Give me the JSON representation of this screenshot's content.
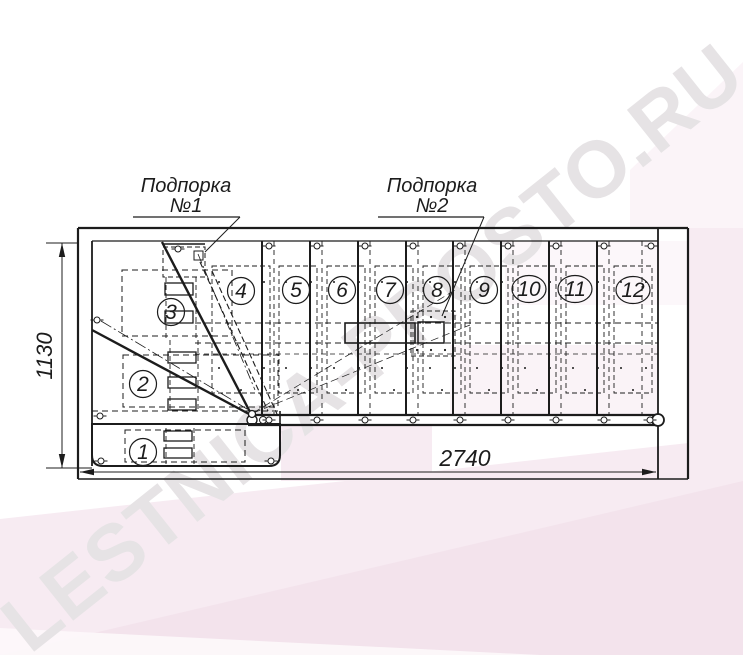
{
  "title": "Staircase plan drawing",
  "watermark": {
    "text": "LESTNICA-PROSTO.RU"
  },
  "labels": {
    "support1_line1": "Подпорка",
    "support1_line2": "№1",
    "support2_line1": "Подпорка",
    "support2_line2": "№2"
  },
  "dimensions": {
    "height": "1130",
    "length": "2740"
  },
  "steps": [
    "1",
    "2",
    "3",
    "4",
    "5",
    "6",
    "7",
    "8",
    "9",
    "10",
    "11",
    "12"
  ],
  "icons": {
    "bolt": "bolt-symbol",
    "dimension_arrow": "dimension-arrow"
  },
  "colors": {
    "line": "#1c1c1c",
    "pink_light": "#f7ebf2",
    "pink_mid": "#f4e4ee",
    "pink_dark": "#f0dcE8",
    "watermark_gray": "#e6e3e5"
  }
}
